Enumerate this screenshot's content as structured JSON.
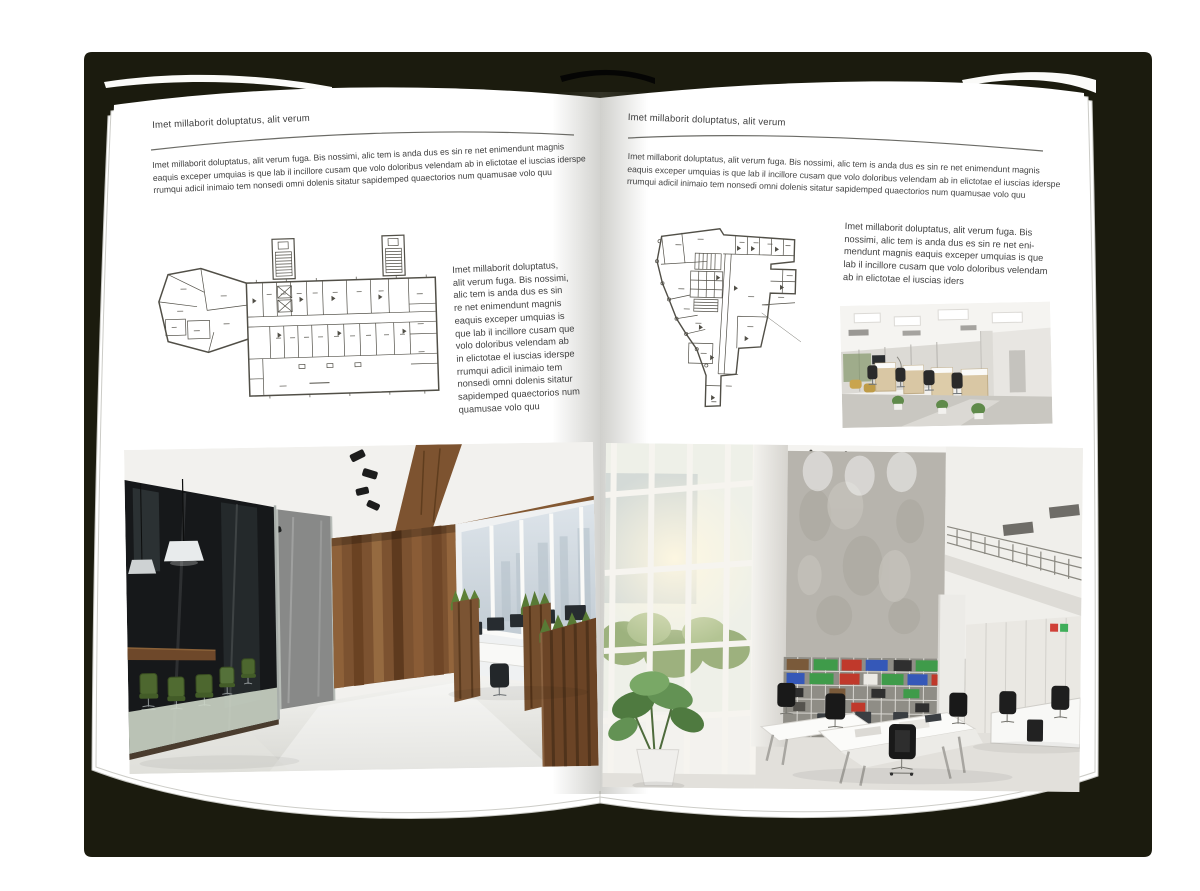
{
  "document": {
    "kind": "open magazine spread mockup",
    "cover_color": "#1b1b0e",
    "page_color": "#ffffff",
    "text_color": "#3e3e3e"
  },
  "left_page": {
    "header": "Imet millaborit doluptatus, alit verum",
    "intro": "Imet millaborit doluptatus, alit verum fuga. Bis nossimi, alic tem is anda dus es sin re net enimendunt magnis\neaquis exceper umquias is que lab il incillore cusam que volo doloribus velendam ab in elictotae el iuscias iderspe\nrrumqui adicil inimaio tem nonsedi omni dolenis sitatur sapidemped quaectorios num quamusae volo quu",
    "side_text": "Imet millaborit doluptatus,\nalit verum fuga. Bis nossimi,\nalic tem is anda dus es sin\nre net enimendunt magnis\neaquis exceper umquias is\nque lab il incillore cusam que\nvolo doloribus velendam ab\nin elictotae el iuscias iderspe\nrrumqui adicil inimaio tem\nnonsedi omni dolenis sitatur\nsapidemped quaectorios num\nquamusae volo quu",
    "figures": {
      "floor_plan": "architectural floor plan with two stair towers and angled left wing",
      "photo": "loft office: dark glass meeting room, green chairs, wood feature wall, window workstations"
    }
  },
  "right_page": {
    "header": "Imet millaborit doluptatus, alit verum",
    "intro": "Imet millaborit doluptatus, alit verum fuga. Bis nossimi, alic tem is anda dus es sin re net enimendunt magnis\neaquis exceper umquias is que lab il incillore cusam que volo doloribus velendam ab in elictotae el iuscias iderspe\nrrumqui adicil inimaio tem nonsedi omni dolenis sitatur sapidemped quaectorios num quamusae volo quu",
    "side_text": "Imet millaborit doluptatus, alit verum fuga. Bis\nnossimi, alic tem is anda dus es sin re net eni-\nmendunt magnis eaquis exceper umquias is que\nlab il incillore cusam que volo doloribus velendam\nab in elictotae el iuscias iders",
    "figures": {
      "floor_plan": "irregular wedge-shaped floor plan with central core and bottom stub",
      "photo_small": "open-plan office with beige workstation cubicles and black chairs",
      "photo_large": "double-height bright office: window wall, concrete wall, binder shelves, white desks"
    }
  }
}
